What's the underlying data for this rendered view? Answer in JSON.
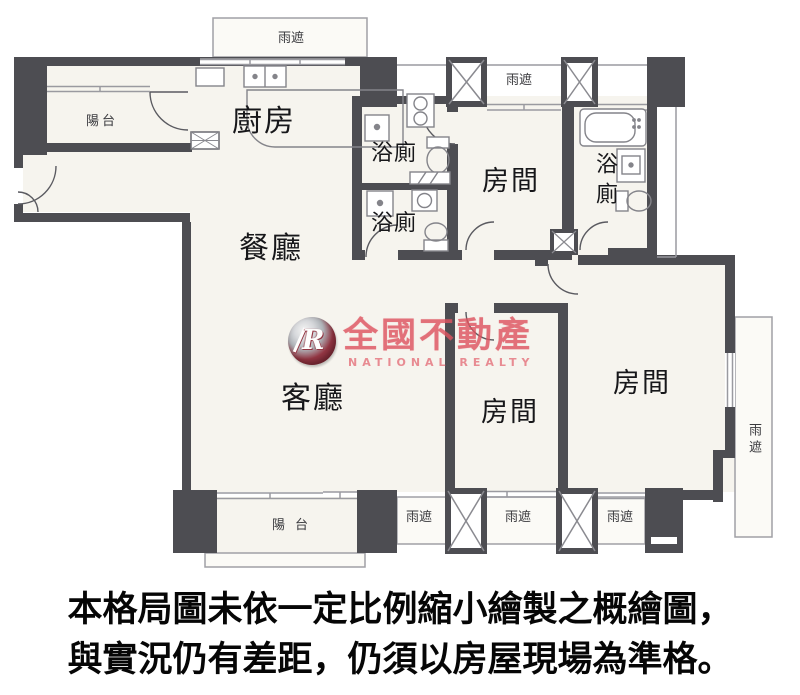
{
  "rooms": {
    "kitchen": "廚房",
    "dining": "餐廳",
    "living": "客廳",
    "bedroom_top": "房間",
    "bedroom_middle": "房間",
    "bedroom_right": "房間",
    "bath_upper": "浴廁",
    "bath_lower": "浴廁",
    "bath_right": "浴廁",
    "balcony_top": "陽台",
    "balcony_bottom": "陽台"
  },
  "canopy": {
    "label": "雨遮"
  },
  "watermark": {
    "monogram": "R",
    "brand": "全國不動產",
    "brand_en": "NATIONAL REALTY",
    "brand_color": "#de5460"
  },
  "caption": {
    "line1": "本格局圖未依一定比例縮小繪製之概繪圖，",
    "line2": "與實況仍有差距，仍須以房屋現場為準格。"
  },
  "colors": {
    "wall_gray": "#4d4d52",
    "brand_red": "#de5460"
  }
}
